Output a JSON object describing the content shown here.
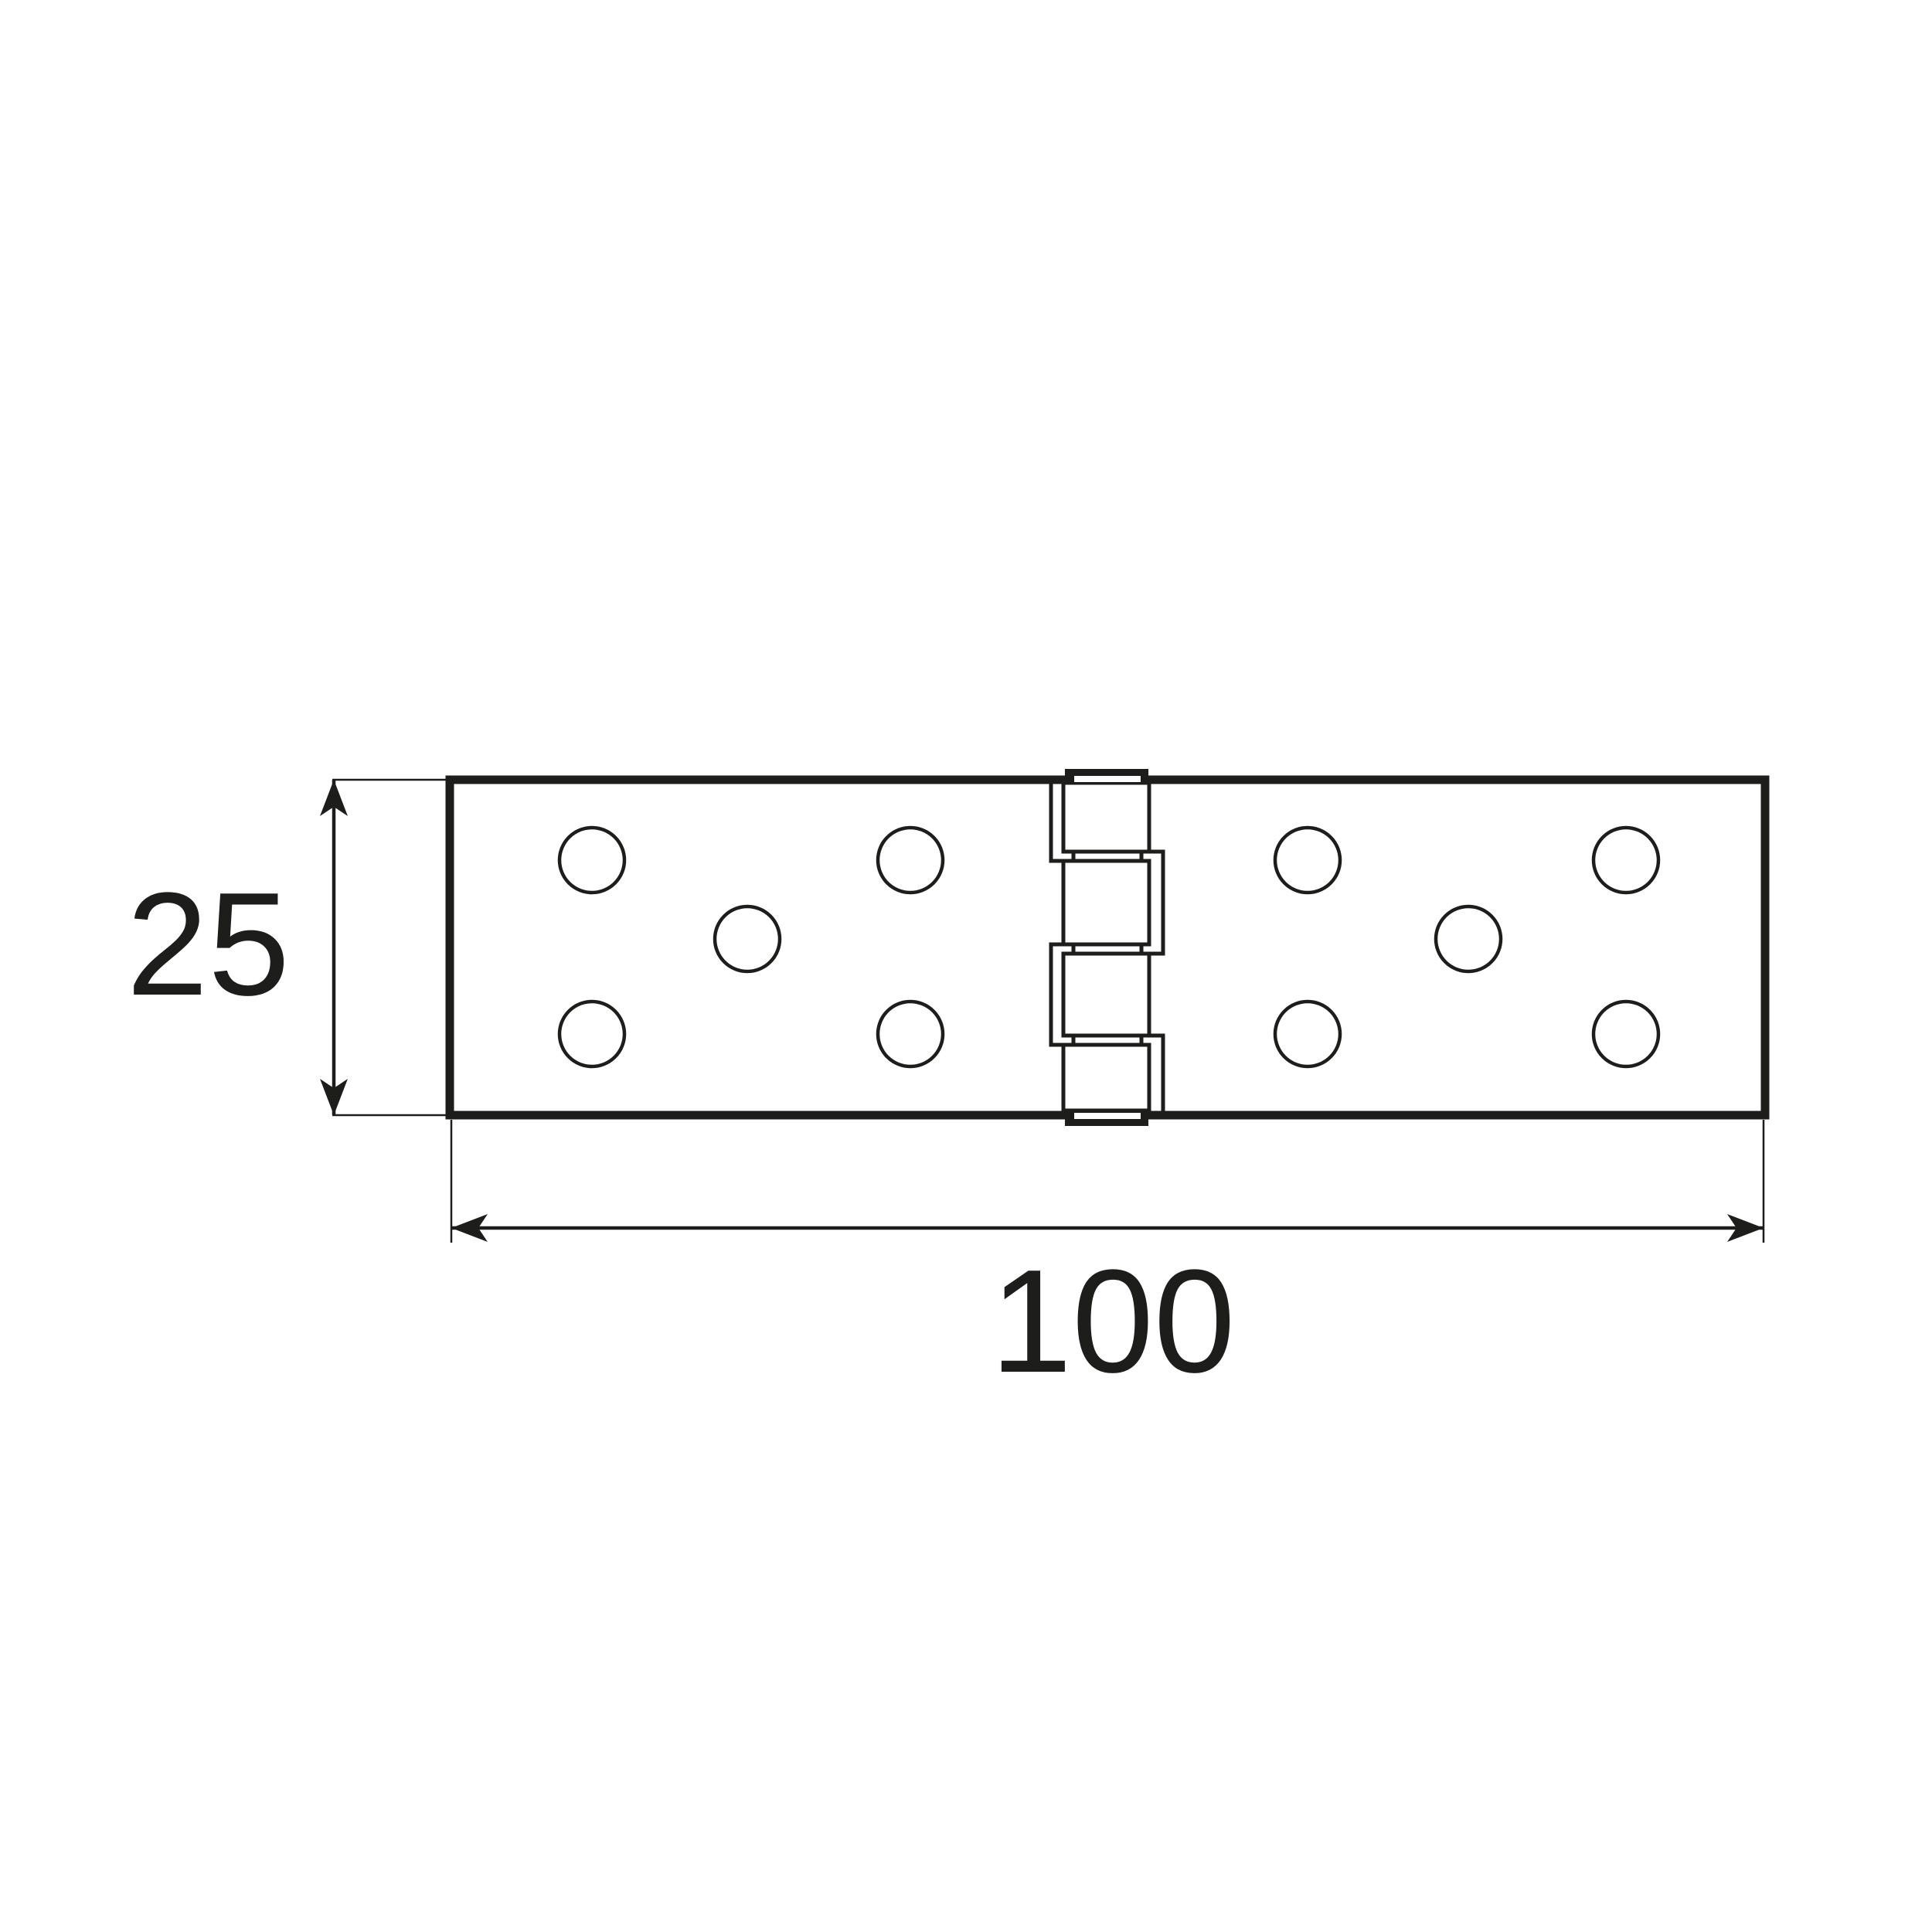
{
  "drawing": {
    "kind": "technical-dimension-drawing",
    "subject": "hinge-top-view",
    "background_color": "#ffffff",
    "line_color": "#1d1d1b",
    "width_dimension": {
      "label": "100"
    },
    "height_dimension": {
      "label": "25"
    },
    "plate": {
      "holes_per_leaf": 5,
      "total_holes": 10,
      "knuckle_segments": 4
    }
  }
}
